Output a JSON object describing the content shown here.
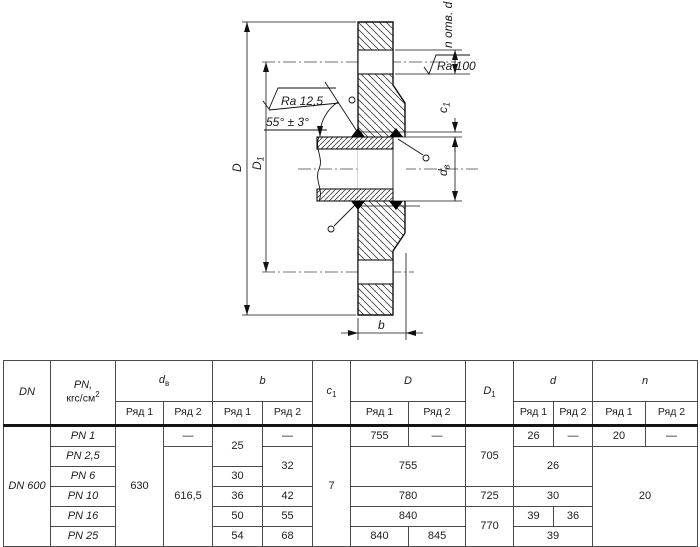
{
  "drawing": {
    "labels": {
      "D": "D",
      "D1_base": "D",
      "D1_sub": "1",
      "b": "b",
      "c1_base": "c",
      "c1_sub": "1",
      "dv_base": "d",
      "dv_sub": "в",
      "n_holes": "n отв. d",
      "ra100": "Ra 100",
      "ra125": "Ra 12,5",
      "angle": "55° ± 3°"
    }
  },
  "table": {
    "header": {
      "dn": "DN",
      "pn_title": "PN,",
      "pn_unit_base": "кгс/см",
      "pn_unit_sup": "2",
      "dv_base": "d",
      "dv_sub": "в",
      "b": "b",
      "c1_base": "c",
      "c1_sub": "1",
      "D": "D",
      "D1_base": "D",
      "D1_sub": "1",
      "d": "d",
      "n": "n",
      "row1": "Ряд 1",
      "row2": "Ряд 2"
    },
    "body": {
      "dn": "DN 600",
      "pn": [
        "PN 1",
        "PN 2,5",
        "PN 6",
        "PN 10",
        "PN 16",
        "PN 25"
      ],
      "dash": "—",
      "dv_row1": "630",
      "dv_row2": "616,5",
      "b1_r12": "25",
      "b1_r3": "30",
      "b1_r4": "36",
      "b1_r5": "50",
      "b1_r6": "54",
      "b2_r23": "32",
      "b2_r4": "42",
      "b2_r5": "55",
      "b2_r6": "68",
      "c1": "7",
      "D_r1": "755",
      "D_r23": "755",
      "D_r4": "780",
      "D_r5": "840",
      "D_r6_1": "840",
      "D_r6_2": "845",
      "D1_r123": "705",
      "D1_r4": "725",
      "D1_r56": "770",
      "d_r1": "26",
      "d_r23": "26",
      "d_r4": "30",
      "d_r5_1": "39",
      "d_r5_2": "36",
      "d_r6": "39",
      "n_r1": "20",
      "n_rest": "20"
    }
  }
}
